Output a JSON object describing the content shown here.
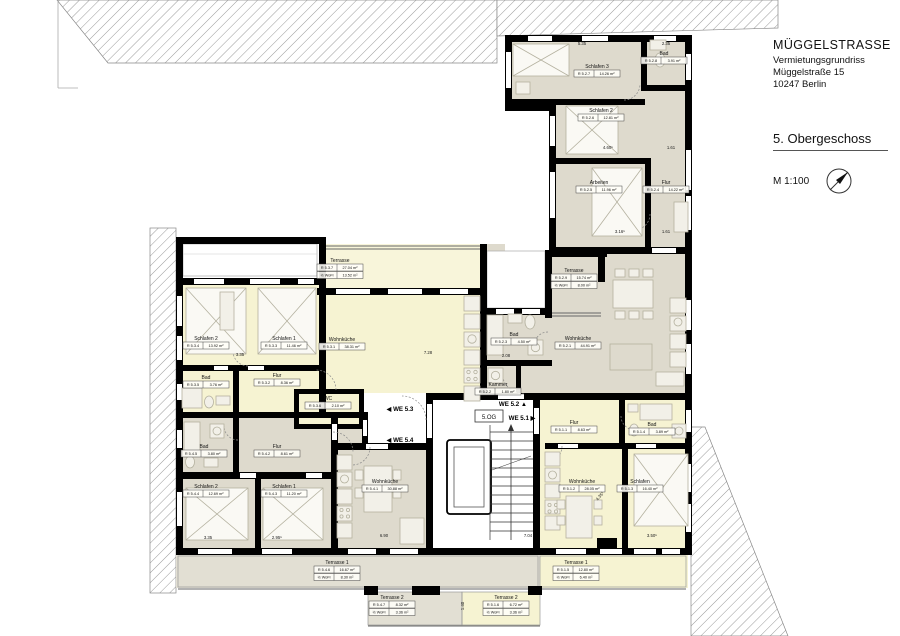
{
  "title_block": {
    "project": "MÜGGELSTRASSE",
    "drawing_type": "Vermietungsgrundriss",
    "address_line1": "Müggelstraße 15",
    "address_line2": "10247 Berlin",
    "floor_title": "5. Obergeschoss",
    "scale_label": "M 1:100"
  },
  "core": {
    "floor_tag": "5.OG"
  },
  "share_label": "½ WoFl",
  "unit_markers": [
    {
      "label": "WE 5.3",
      "dir": "left",
      "x": 400,
      "y": 411
    },
    {
      "label": "WE 5.4",
      "dir": "left",
      "x": 400,
      "y": 442
    },
    {
      "label": "WE 5.2",
      "dir": "up",
      "x": 513,
      "y": 406
    },
    {
      "label": "WE 5.1",
      "dir": "right",
      "x": 522,
      "y": 420
    }
  ],
  "rooms": [
    {
      "unit": "WE 5.2",
      "name": "Schlafen 3",
      "code": "R 5.2.7",
      "area": "14.26 m²",
      "x": 597,
      "y": 68
    },
    {
      "unit": "WE 5.2",
      "name": "Bad",
      "code": "R 5.2.8",
      "area": "3.91 m²",
      "x": 664,
      "y": 55
    },
    {
      "unit": "WE 5.2",
      "name": "Schlafen 2",
      "code": "R 5.2.6",
      "area": "12.81 m²",
      "x": 601,
      "y": 112
    },
    {
      "unit": "WE 5.2",
      "name": "Arbeiten",
      "code": "R 5.2.5",
      "area": "11.96 m²",
      "x": 599,
      "y": 184
    },
    {
      "unit": "WE 5.2",
      "name": "Flur",
      "code": "R 5.2.4",
      "area": "14.22 m²",
      "x": 666,
      "y": 184
    },
    {
      "unit": "WE 5.2",
      "name": "Terrasse",
      "code": "R 5.2.9",
      "area": "15.74 m²",
      "share": "8.00 m²",
      "x": 574,
      "y": 272
    },
    {
      "unit": "WE 5.2",
      "name": "Wohnküche",
      "code": "R 5.2.1",
      "area": "44.91 m²",
      "x": 578,
      "y": 340
    },
    {
      "unit": "WE 5.2",
      "name": "Bad",
      "code": "R 5.2.3",
      "area": "4.50 m²",
      "x": 514,
      "y": 336
    },
    {
      "unit": "WE 5.2",
      "name": "Kammer",
      "code": "R 5.2.2",
      "area": "1.80 m²",
      "x": 498,
      "y": 386
    },
    {
      "unit": "WE 5.3",
      "name": "Schlafen 2",
      "code": "R 5.3.4",
      "area": "13.92 m²",
      "x": 206,
      "y": 340
    },
    {
      "unit": "WE 5.3",
      "name": "Schlafen 1",
      "code": "R 5.3.3",
      "area": "11.46 m²",
      "x": 284,
      "y": 340
    },
    {
      "unit": "WE 5.3",
      "name": "Bad",
      "code": "R 5.3.5",
      "area": "3.76 m²",
      "x": 206,
      "y": 379
    },
    {
      "unit": "WE 5.3",
      "name": "Flur",
      "code": "R 5.3.2",
      "area": "8.36 m²",
      "x": 277,
      "y": 377
    },
    {
      "unit": "WE 5.3",
      "name": "WC",
      "code": "R 5.3.6",
      "area": "2.10 m²",
      "x": 328,
      "y": 400
    },
    {
      "unit": "WE 5.3",
      "name": "Wohnküche",
      "code": "R 5.3.1",
      "area": "38.31 m²",
      "x": 342,
      "y": 341
    },
    {
      "unit": "WE 5.3",
      "name": "Terrasse",
      "code": "R 5.3.7",
      "area": "27.04 m²",
      "share": "13.52 m²",
      "x": 340,
      "y": 262
    },
    {
      "unit": "WE 5.4",
      "name": "Bad",
      "code": "R 5.4.5",
      "area": "3.80 m²",
      "x": 204,
      "y": 448
    },
    {
      "unit": "WE 5.4",
      "name": "Flur",
      "code": "R 5.4.2",
      "area": "8.61 m²",
      "x": 277,
      "y": 448
    },
    {
      "unit": "WE 5.4",
      "name": "Schlafen 2",
      "code": "R 5.4.4",
      "area": "12.69 m²",
      "x": 206,
      "y": 488
    },
    {
      "unit": "WE 5.4",
      "name": "Schlafen 1",
      "code": "R 5.4.3",
      "area": "11.20 m²",
      "x": 284,
      "y": 488
    },
    {
      "unit": "WE 5.4",
      "name": "Wohnküche",
      "code": "R 5.4.1",
      "area": "30.88 m²",
      "x": 385,
      "y": 483
    },
    {
      "unit": "WE 5.4",
      "name": "Terrasse 1",
      "code": "R 5.4.6",
      "area": "16.67 m²",
      "share": "8.30 m²",
      "x": 337,
      "y": 564
    },
    {
      "unit": "WE 5.4",
      "name": "Terrasse 2",
      "code": "R 5.4.7",
      "area": "8.32 m²",
      "share": "3.36 m²",
      "x": 392,
      "y": 599
    },
    {
      "unit": "WE 5.1",
      "name": "Flur",
      "code": "R 5.1.1",
      "area": "8.63 m²",
      "x": 574,
      "y": 424
    },
    {
      "unit": "WE 5.1",
      "name": "Bad",
      "code": "R 5.1.4",
      "area": "3.89 m²",
      "x": 652,
      "y": 426
    },
    {
      "unit": "WE 5.1",
      "name": "Wohnküche",
      "code": "R 5.1.2",
      "area": "28.05 m²",
      "x": 582,
      "y": 483
    },
    {
      "unit": "WE 5.1",
      "name": "Schlafen",
      "code": "R 5.1.3",
      "area": "16.40 m²",
      "x": 640,
      "y": 483
    },
    {
      "unit": "WE 5.1",
      "name": "Terrasse 1",
      "code": "R 5.1.5",
      "area": "12.80 m²",
      "share": "6.40 m²",
      "x": 576,
      "y": 564
    },
    {
      "unit": "WE 5.1",
      "name": "Terrasse 2",
      "code": "R 5.1.6",
      "area": "6.72 m²",
      "share": "3.36 m²",
      "x": 506,
      "y": 599
    }
  ],
  "dimensions": [
    {
      "t": "5.35",
      "x": 582,
      "y": 45
    },
    {
      "t": "2.35",
      "x": 666,
      "y": 45
    },
    {
      "t": "4.60⁵",
      "x": 608,
      "y": 149
    },
    {
      "t": "1.61",
      "x": 671,
      "y": 149
    },
    {
      "t": "3.16⁵",
      "x": 620,
      "y": 233
    },
    {
      "t": "1.61",
      "x": 666,
      "y": 233
    },
    {
      "t": "3.35",
      "x": 240,
      "y": 356
    },
    {
      "t": "7.28",
      "x": 428,
      "y": 354
    },
    {
      "t": "2.08",
      "x": 506,
      "y": 357
    },
    {
      "t": "3.35",
      "x": 208,
      "y": 539
    },
    {
      "t": "2.95⁵",
      "x": 277,
      "y": 539
    },
    {
      "t": "6.90",
      "x": 384,
      "y": 537
    },
    {
      "t": "7.04",
      "x": 528,
      "y": 537
    },
    {
      "t": "4.35⁵",
      "x": 601,
      "y": 497,
      "r": -50
    },
    {
      "t": "3.50⁵",
      "x": 652,
      "y": 537
    },
    {
      "t": "1.40",
      "x": 464,
      "y": 606,
      "r": -90
    }
  ],
  "colors": {
    "unit_yellow": "#f6f3d2",
    "unit_grey": "#dedacd",
    "terrace_grey": "#e2dfd3",
    "wall": "#000000",
    "hatch_line": "#999999"
  }
}
